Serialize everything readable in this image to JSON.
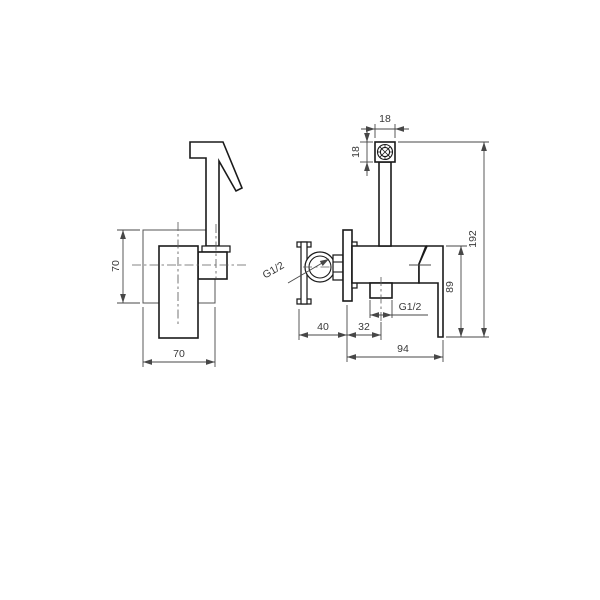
{
  "drawing": {
    "kind": "technical-drawing-bidet-sprayer-mixer",
    "front_view": {
      "plate_height": "70",
      "plate_width": "70"
    },
    "side_view": {
      "head_width": "18",
      "head_height": "18",
      "overall_height": "192",
      "handle_height": "89",
      "inlet_offset": "40",
      "outlet_offset": "32",
      "total_depth": "94",
      "inlet_thread": "G1/2",
      "outlet_thread": "G1/2"
    },
    "colors": {
      "line": "#1a1a1a",
      "dim": "#474747",
      "background": "#ffffff"
    }
  }
}
